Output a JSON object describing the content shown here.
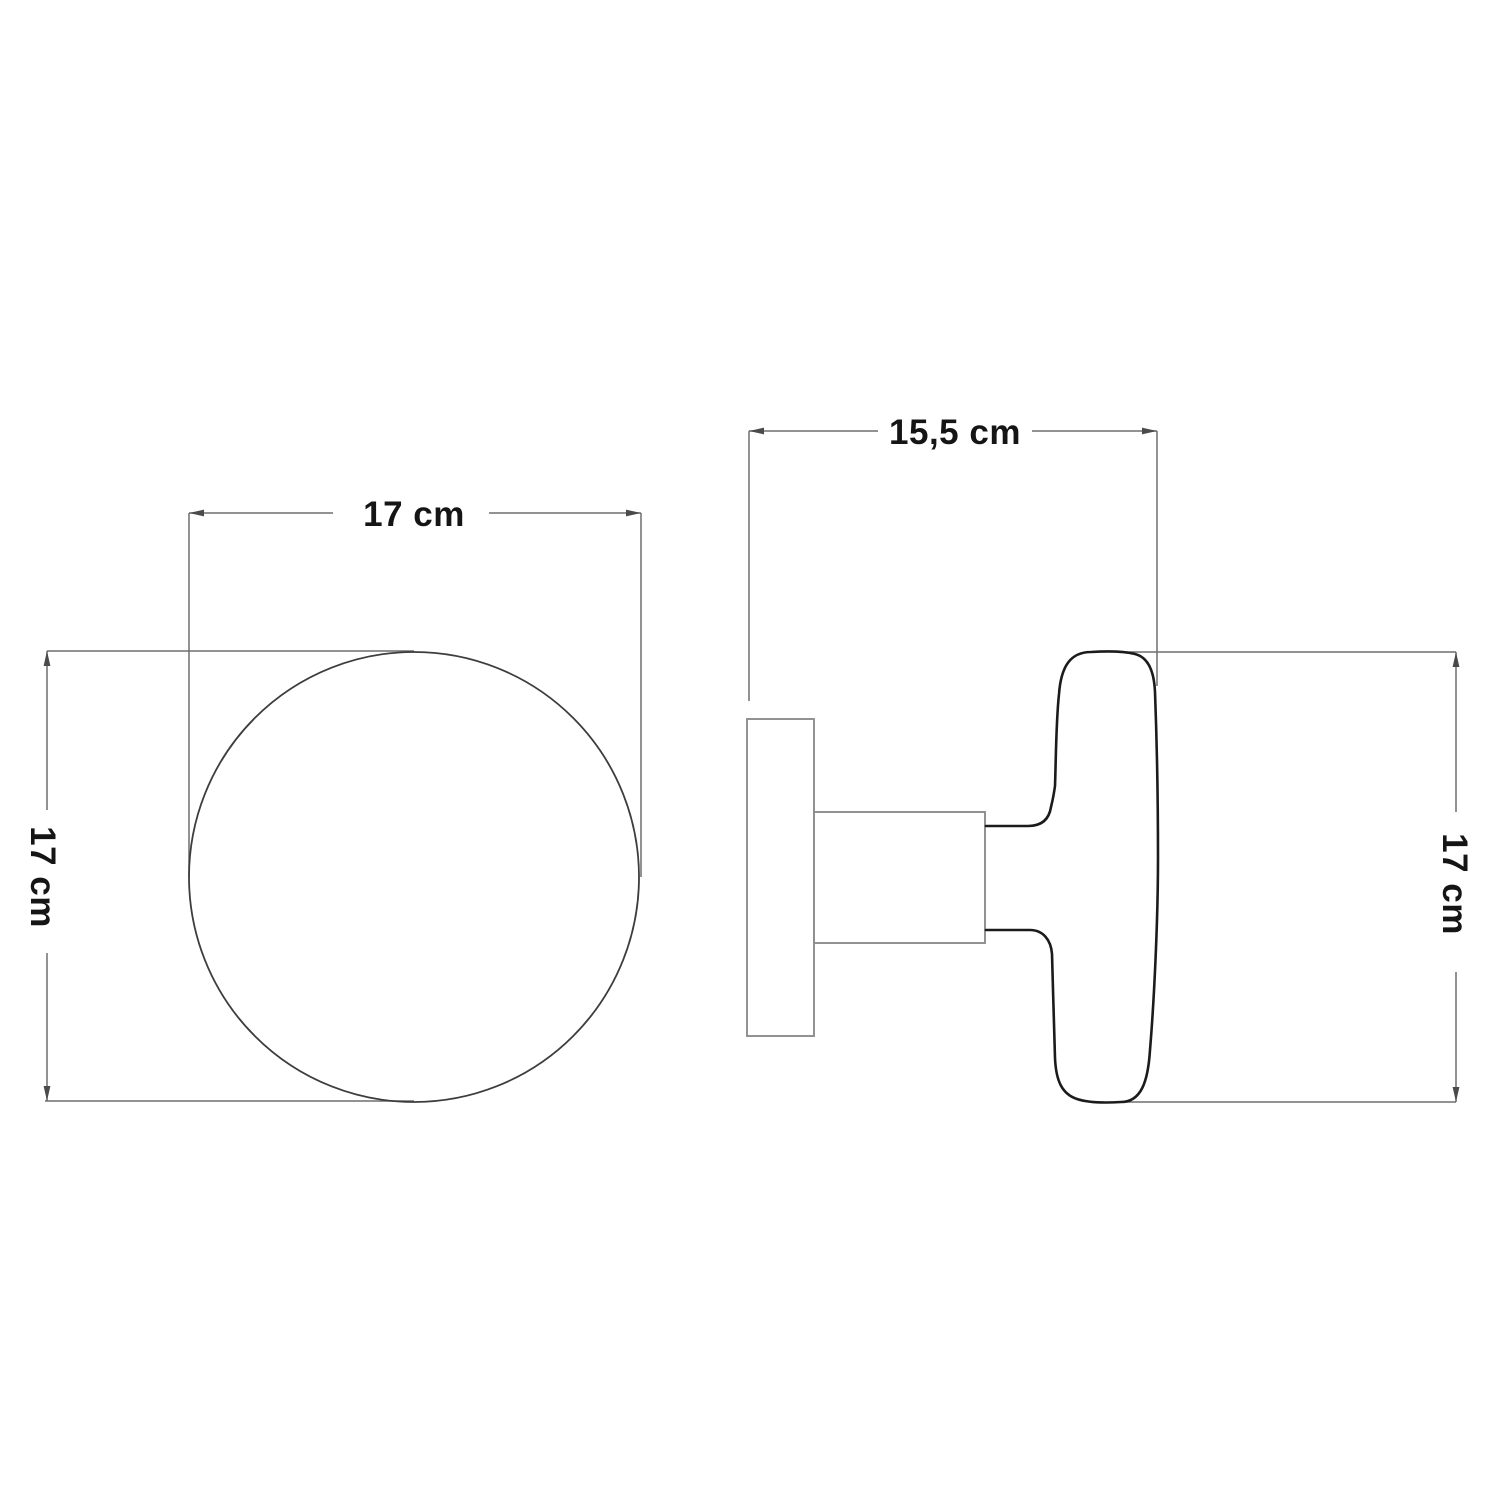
{
  "page": {
    "background": "#ffffff"
  },
  "colors": {
    "background": "#ffffff",
    "dimension_line": "#6f6f6f",
    "arrow": "#4a4a4a",
    "text": "#151515",
    "front_outline": "#3d3d3d",
    "mount_outline": "#8d8d8d",
    "knob_outline": "#1b1b1b"
  },
  "diagram": {
    "front_view": {
      "width_label": "17 cm",
      "height_label": "17 cm"
    },
    "side_view": {
      "depth_label": "15,5 cm",
      "height_label": "17 cm"
    }
  }
}
